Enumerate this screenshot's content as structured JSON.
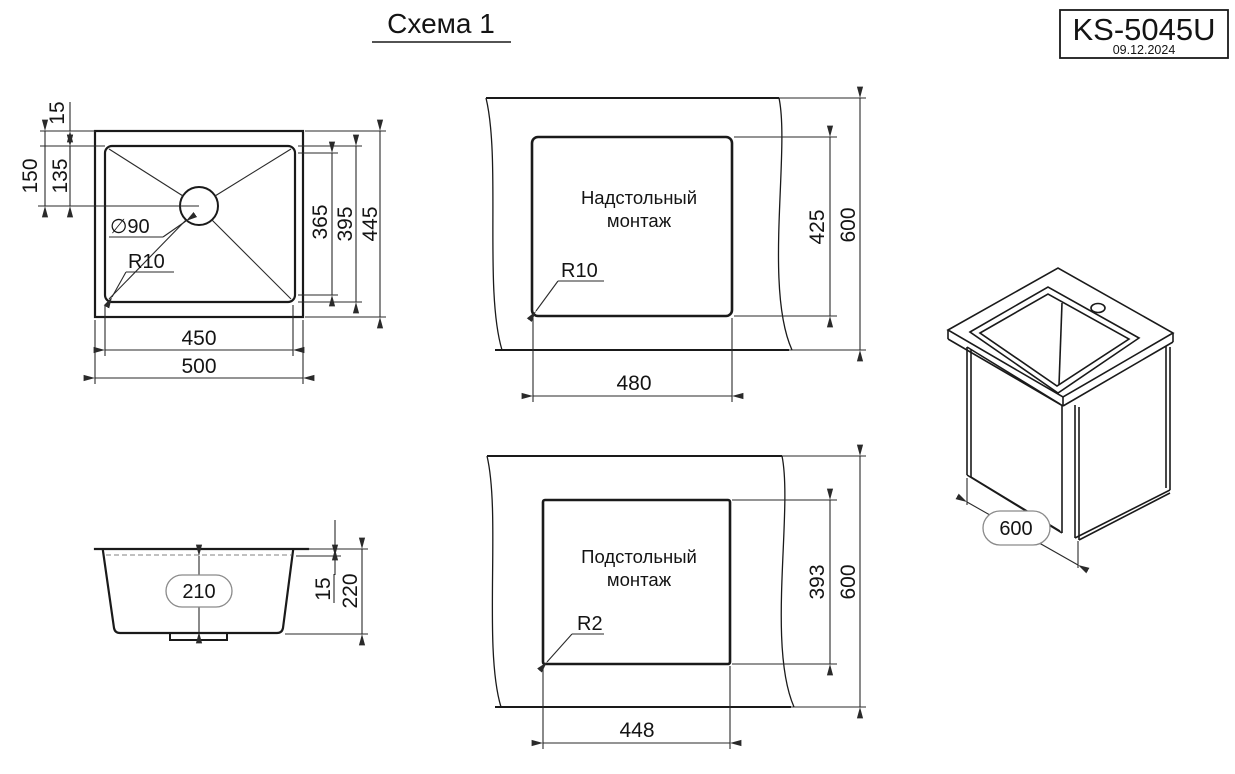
{
  "title": "Схема 1",
  "title_block": {
    "model": "KS-5045U",
    "date": "09.12.2024"
  },
  "top_view": {
    "dim_rim": "15",
    "dim_drain_offset": "150",
    "dim_drain_offset_inner": "135",
    "dim_bowl_flat_height": "365",
    "dim_bowl_height": "395",
    "dim_outer_height": "445",
    "dim_bowl_width": "450",
    "dim_outer_width": "500",
    "drain_label": "∅90",
    "radius_label": "R10"
  },
  "overmount_view": {
    "label_line1": "Надстольный",
    "label_line2": "монтаж",
    "radius_label": "R10",
    "dim_cutout_height": "425",
    "dim_counter_depth": "600",
    "dim_cutout_width": "480"
  },
  "undermount_view": {
    "label_line1": "Подстольный",
    "label_line2": "монтаж",
    "radius_label": "R2",
    "dim_cutout_height": "393",
    "dim_counter_depth": "600",
    "dim_cutout_width": "448"
  },
  "side_view": {
    "dim_bowl_depth": "210",
    "dim_rim": "15",
    "dim_total_height": "220"
  },
  "iso_view": {
    "dim_depth": "600"
  }
}
